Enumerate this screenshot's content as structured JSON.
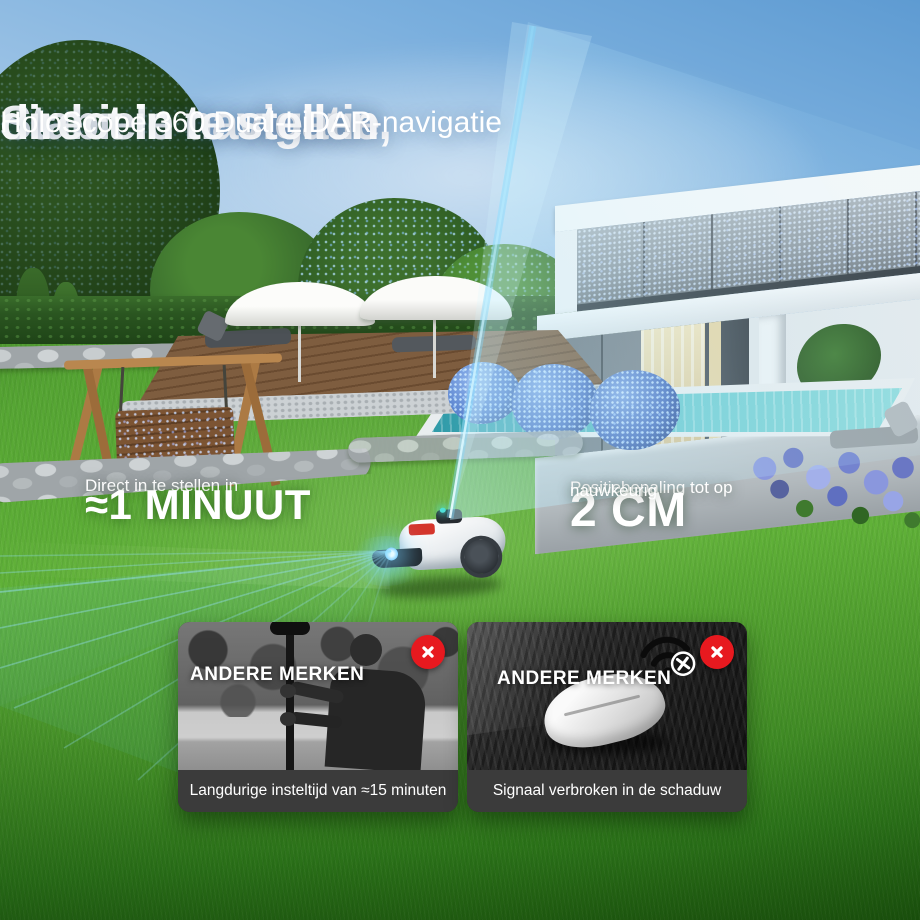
{
  "header": {
    "title_line1": "Stabiele navigatie,",
    "title_line2": "direct in te stellen",
    "subtitle": "HoloScope 360 Dual-LiDAR-navigatie"
  },
  "stats": {
    "setup": {
      "label": "Direct in te stellen in",
      "value": "≈1 MINUUT"
    },
    "accuracy": {
      "label": "Positiebepaling tot op",
      "value": "2 CM",
      "note": "nauwkeurig"
    }
  },
  "cards": [
    {
      "tag": "ANDERE MERKEN",
      "caption": "Langdurige insteltijd van ≈15 minuten",
      "icon": "x-circle-icon"
    },
    {
      "tag": "ANDERE MERKEN",
      "caption": "Signaal verbroken in de schaduw",
      "icon": "x-circle-icon",
      "overlay_icon": "wifi-off-icon"
    }
  ],
  "colors": {
    "accent_red": "#e7191f",
    "lidar_blue": "#8ee6ff",
    "caption_bar": "#3b3b3b",
    "headline_white": "#ffffff"
  }
}
